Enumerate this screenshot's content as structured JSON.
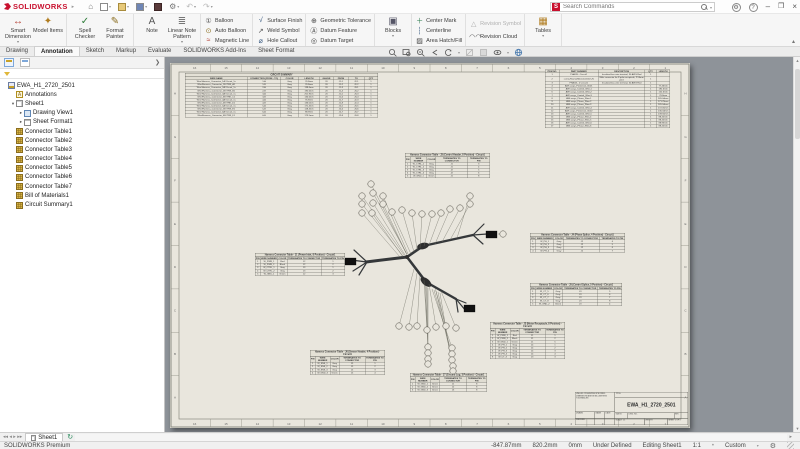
{
  "window": {
    "logo": "SOLIDWORKS",
    "search_placeholder": "Search Commands"
  },
  "ribbon": {
    "tabs": [
      "Drawing",
      "Annotation",
      "Sketch",
      "Markup",
      "Evaluate",
      "SOLIDWORKS Add-Ins",
      "Sheet Format"
    ],
    "active_tab": "Annotation",
    "groups": [
      {
        "type": "big",
        "buttons": [
          {
            "label": "Smart Dimension",
            "icon": "smart-dimension",
            "caret": true
          },
          {
            "label": "Model Items",
            "icon": "model-items"
          }
        ]
      },
      {
        "type": "big",
        "buttons": [
          {
            "label": "Spell Checker",
            "icon": "spell-checker"
          },
          {
            "label": "Format Painter",
            "icon": "format-painter"
          }
        ]
      },
      {
        "type": "big",
        "buttons": [
          {
            "label": "Note",
            "icon": "note"
          },
          {
            "label": "Linear Note Pattern",
            "icon": "linear-note-pattern",
            "caret": true
          }
        ]
      },
      {
        "type": "stack",
        "buttons": [
          {
            "label": "Balloon",
            "icon": "balloon"
          },
          {
            "label": "Auto Balloon",
            "icon": "auto-balloon"
          },
          {
            "label": "Magnetic Line",
            "icon": "magnetic-line"
          }
        ]
      },
      {
        "type": "stack",
        "buttons": [
          {
            "label": "Surface Finish",
            "icon": "surface-finish"
          },
          {
            "label": "Weld Symbol",
            "icon": "weld-symbol"
          },
          {
            "label": "Hole Callout",
            "icon": "hole-callout"
          }
        ]
      },
      {
        "type": "stack",
        "buttons": [
          {
            "label": "Geometric Tolerance",
            "icon": "geometric-tolerance"
          },
          {
            "label": "Datum Feature",
            "icon": "datum-feature"
          },
          {
            "label": "Datum Target",
            "icon": "datum-target"
          }
        ]
      },
      {
        "type": "big",
        "buttons": [
          {
            "label": "Blocks",
            "icon": "blocks",
            "caret": true
          }
        ]
      },
      {
        "type": "stack",
        "buttons": [
          {
            "label": "Center Mark",
            "icon": "center-mark"
          },
          {
            "label": "Centerline",
            "icon": "centerline"
          },
          {
            "label": "Area Hatch/Fill",
            "icon": "area-hatch"
          }
        ]
      },
      {
        "type": "stack",
        "buttons": [
          {
            "label": "Revision Symbol",
            "icon": "revision-symbol",
            "disabled": true
          },
          {
            "label": "Revision Cloud",
            "icon": "revision-cloud"
          }
        ]
      },
      {
        "type": "big",
        "buttons": [
          {
            "label": "Tables",
            "icon": "tables",
            "caret": true
          }
        ]
      }
    ]
  },
  "tree": {
    "items": [
      {
        "label": "EWA_H1_2720_2501",
        "icon": "ti-doc",
        "depth": 0,
        "arrow": ""
      },
      {
        "label": "Annotations",
        "icon": "ti-note",
        "depth": 1,
        "arrow": "",
        "glyph": "A"
      },
      {
        "label": "Sheet1",
        "icon": "ti-sheet",
        "depth": 1,
        "arrow": "expanded"
      },
      {
        "label": "Drawing View1",
        "icon": "ti-view",
        "depth": 2,
        "arrow": "collapsed"
      },
      {
        "label": "Sheet Format1",
        "icon": "ti-format",
        "depth": 2,
        "arrow": "collapsed"
      },
      {
        "label": "Connector Table1",
        "icon": "ti-table",
        "depth": 1,
        "arrow": ""
      },
      {
        "label": "Connector Table2",
        "icon": "ti-table",
        "depth": 1,
        "arrow": ""
      },
      {
        "label": "Connector Table3",
        "icon": "ti-table",
        "depth": 1,
        "arrow": ""
      },
      {
        "label": "Connector Table4",
        "icon": "ti-table",
        "depth": 1,
        "arrow": ""
      },
      {
        "label": "Connector Table5",
        "icon": "ti-table",
        "depth": 1,
        "arrow": ""
      },
      {
        "label": "Connector Table6",
        "icon": "ti-table",
        "depth": 1,
        "arrow": ""
      },
      {
        "label": "Connector Table7",
        "icon": "ti-table",
        "depth": 1,
        "arrow": ""
      },
      {
        "label": "Bill of Materials1",
        "icon": "ti-table",
        "depth": 1,
        "arrow": ""
      },
      {
        "label": "Circuit Summary1",
        "icon": "ti-table",
        "depth": 1,
        "arrow": ""
      }
    ]
  },
  "sheet": {
    "zones_h": [
      "16",
      "15",
      "14",
      "13",
      "12",
      "11",
      "10",
      "9",
      "8",
      "7",
      "6",
      "5",
      "4",
      "3",
      "2",
      "1"
    ],
    "zones_v": [
      "H",
      "G",
      "F",
      "E",
      "D",
      "C",
      "B",
      "A"
    ],
    "circuit_summary": {
      "title": "CIRCUIT SUMMARY",
      "headers": [
        "WIRE NAME",
        "CONNECTION (FROM - TO)",
        "COLOR",
        "LENGTH",
        "GAUGE",
        "FROM",
        "TO",
        "QTY"
      ],
      "rows": [
        [
          "Wire/Harness_Connector_1A /Circuit_1s",
          "1-A",
          "Gray",
          "76.8mm",
          "20",
          "J1-1",
          "J2-1",
          "1"
        ],
        [
          "Wire/Harness_Connector_1B /TRK_A1",
          "1-B",
          "Gray",
          "76.8mm",
          "20",
          "J1-2",
          "J2-2",
          "1"
        ],
        [
          "Wire/Harness_Connector_2A /Circuit_1s",
          "2-A",
          "Gray",
          "138.6mm",
          "20",
          "J1-3",
          "J3-1",
          "1"
        ],
        [
          "Wire/Harness_Connector_2B /TRK_B1",
          "2-B",
          "Gray",
          "192.6mm",
          "20",
          "J1-4",
          "J3-2",
          "1"
        ],
        [
          "Wire/Harness_Connector_3A /Circuit_1s",
          "3-A",
          "Gray",
          "201.9mm",
          "20",
          "J1-5",
          "J3-3",
          "1"
        ],
        [
          "Wire/Harness_Connector_3B /TRK_C1",
          "3-B",
          "Gray",
          "134.6mm",
          "20",
          "J1-6",
          "J3-4",
          "1"
        ],
        [
          "Wire/Harness_Connector_4A /Circuit_1s",
          "4-A",
          "Gray",
          "76.8mm",
          "20",
          "J1-7",
          "J2-3",
          "1"
        ],
        [
          "Wire/Harness_Connector_4B /TRK_D1",
          "4-B",
          "Gray",
          "136.0mm",
          "20",
          "J1-8",
          "J2-4",
          "1"
        ],
        [
          "Wire/Harness_Connector_5A /Circuit_1s",
          "5-A",
          "Gray",
          "171.4mm",
          "20",
          "J2-5",
          "J3-5",
          "1"
        ],
        [
          "Wire/Harness_Connector_5B /TRK_E1",
          "5-B",
          "Gray",
          "128.4mm",
          "20",
          "J2-6",
          "J3-6",
          "1"
        ],
        [
          "Wire/Harness_Connector_6A /Circuit_1s",
          "6-A",
          "Gray",
          "88.9mm",
          "20",
          "J2-7",
          "J3-7",
          "1"
        ],
        [
          "Wire/Harness_Connector_6B /TRK_F1",
          "6-B",
          "Gray",
          "173.5mm",
          "20",
          "J2-8",
          "J3-8",
          "1"
        ]
      ]
    },
    "bom": {
      "headers": [
        "ITEM NO.",
        "PART NUMBER",
        "DESCRIPTION",
        "QTY.",
        "LENGTH"
      ],
      "rows": [
        [
          "1",
          "PHACB - Circuit1",
          "Insulated bus wire terminal, 30 AWG Red",
          "1",
          ""
        ],
        [
          "2",
          "screw-Round-M2x0.4x16mm-N",
          "Male connector for 8 pole receptacle, 2.54mm pitch",
          "1",
          ""
        ],
        [
          "3",
          "PHACB - 2 Circuit1",
          "Insulated bus wire terminal, 30 AWG Red",
          "1",
          ""
        ],
        [
          "4",
          "AWI assys_Protection_W-01",
          "",
          "1",
          "77.46mm"
        ],
        [
          "5",
          "AWI assys_Control_Wire-1",
          "",
          "1",
          "192.6mm"
        ],
        [
          "6",
          "AWI assys_Control_Wire-2",
          "",
          "1",
          "152.6mm"
        ],
        [
          "7",
          "AWI assys_Control_Wire-3",
          "",
          "1",
          "76.8mm"
        ],
        [
          "8",
          "AWI assys_Phase_Wire-1",
          "",
          "1",
          "165.04mm"
        ],
        [
          "9",
          "AWI assys_Phase_Wire-2",
          "",
          "1",
          "171.76mm"
        ],
        [
          "10",
          "AWI assys_Phase_Wire-3",
          "",
          "1",
          "165.04mm"
        ],
        [
          "11",
          "AWI assys_Control_Wire-4",
          "",
          "1",
          "172.05mm"
        ],
        [
          "12",
          "AWI assys_Protection_W-02",
          "",
          "1",
          "136.34mm"
        ],
        [
          "13",
          "AWI assys_Control_Wire-5",
          "",
          "1",
          "139.56mm"
        ],
        [
          "14",
          "AWI assys_Phase_Wire-4",
          "",
          "1",
          "88.45mm"
        ],
        [
          "15",
          "AWI assys_Phase_Wire-5",
          "",
          "1",
          "88.45mm"
        ],
        [
          "16",
          "AWI assys_Control_Wire-6",
          "",
          "1",
          "88.93mm"
        ],
        [
          "17",
          "AWI assys_Phase_Wire-6",
          "",
          "1",
          "88.45mm"
        ]
      ]
    },
    "connector_headers": [
      "PIN",
      "WIRE NUMBER",
      "COLOR",
      "TERMINATES TO CONNECTOR",
      "TERMINATES TO PIN"
    ],
    "connector_tables": [
      {
        "title": "Harness Connector Table - J3 (Control Header, 8 Position) - Circuit1",
        "rows": [
          [
            "1",
            "W_CTRL_1",
            "Gray",
            "J1",
            "3"
          ],
          [
            "2",
            "W_CTRL_2",
            "Gray",
            "J1",
            "4"
          ],
          [
            "3",
            "W_CTRL_3",
            "Gray",
            "J2",
            "5"
          ],
          [
            "4",
            "W_CTRL_4",
            "Gray",
            "J2",
            "6"
          ],
          [
            "5",
            "W_GND_1",
            "Green",
            "J1",
            "8"
          ]
        ]
      },
      {
        "title": "Harness Connector Table - J1 (Power Inlet, 8 Position) - Circuit1",
        "rows": [
          [
            "1",
            "W_PWR_1",
            "Red",
            "J2",
            "1"
          ],
          [
            "2",
            "W_PWR_2",
            "Black",
            "J2",
            "2"
          ],
          [
            "3",
            "W_CTRL_1",
            "Gray",
            "J3",
            "1"
          ],
          [
            "4",
            "W_CTRL_2",
            "Gray",
            "J3",
            "2"
          ],
          [
            "5",
            "W_GND_1",
            "Green",
            "J2",
            "3"
          ]
        ]
      },
      {
        "title": "Harness Connector Table - J4 (Phase Splice, 4 Position) - Circuit1",
        "rows": [
          [
            "1",
            "W_PH_1",
            "Gray",
            "J2",
            "4"
          ],
          [
            "2",
            "W_PH_2",
            "Gray",
            "J2",
            "5"
          ],
          [
            "3",
            "W_PH_3",
            "Gray",
            "J2",
            "6"
          ],
          [
            "4",
            "W_PH_4",
            "Gray",
            "J2",
            "7"
          ]
        ]
      },
      {
        "title": "Harness Connector Table - J5 (Control Splice, 5 Position) - Circuit1",
        "rows": [
          [
            "1",
            "W_CT_5",
            "Gray",
            "J3",
            "5"
          ],
          [
            "2",
            "W_CT_6",
            "Gray",
            "J3",
            "6"
          ],
          [
            "3",
            "W_CT_7",
            "Gray",
            "J3",
            "7"
          ],
          [
            "4",
            "W_CT_8",
            "Gray",
            "J3",
            "8"
          ],
          [
            "5",
            "W_GND_2",
            "Green",
            "J3",
            "4"
          ]
        ]
      },
      {
        "title": "Harness Connector Table - J2 (Motor Receptacle, 8 Position) - Circuit1",
        "rows": [
          [
            "1",
            "W_PWR_1",
            "Red",
            "J1",
            "1"
          ],
          [
            "2",
            "W_PWR_2",
            "Black",
            "J1",
            "2"
          ],
          [
            "3",
            "W_GND_1",
            "Green",
            "J1",
            "5"
          ],
          [
            "4",
            "W_PH_1",
            "Gray",
            "J4",
            "1"
          ],
          [
            "5",
            "W_PH_2",
            "Gray",
            "J4",
            "2"
          ],
          [
            "6",
            "W_PH_3",
            "Gray",
            "J4",
            "3"
          ],
          [
            "7",
            "W_PH_4",
            "Gray",
            "J4",
            "4"
          ],
          [
            "8",
            "W_CT_3",
            "Gray",
            "J3",
            "3"
          ]
        ]
      },
      {
        "title": "Harness Connector Table - J6 (Sensor Header, 4 Position) - Circuit1",
        "rows": [
          [
            "1",
            "W_SNS_1",
            "Gray",
            "J5",
            "1"
          ],
          [
            "2",
            "W_SNS_2",
            "Gray",
            "J5",
            "2"
          ],
          [
            "3",
            "W_SNS_3",
            "Gray",
            "J5",
            "3"
          ],
          [
            "4",
            "W_GND_3",
            "Green",
            "J5",
            "4"
          ]
        ]
      },
      {
        "title": "Harness Connector Table - J7 (Ground Lug, 3 Position) - Circuit1",
        "rows": [
          [
            "1",
            "W_GND_1",
            "Green",
            "J1",
            "8"
          ],
          [
            "2",
            "W_GND_2",
            "Green",
            "J2",
            "8"
          ],
          [
            "3",
            "W_GND_3",
            "Green",
            "J3",
            "8"
          ]
        ]
      }
    ],
    "title_block": {
      "note1": "UNLESS OTHERWISE SPECIFIED:",
      "note2": "DIMENSIONS ARE IN MILLIMETERS",
      "note3": "TOLERANCES:",
      "name_label": "NAME",
      "date_label": "DATE",
      "drawn_label": "DRAWN",
      "checked_label": "CHECKED",
      "title_label": "TITLE:",
      "size_label": "SIZE",
      "size": "B",
      "dwgno_label": "DWG. NO.",
      "rev_label": "REV",
      "dwg_no": "EWA_H1_2720_2501",
      "scale": "SCALE: 1:1",
      "weight": "WEIGHT:",
      "sheet": "SHEET 1 OF 1"
    }
  },
  "sheet_tabs": {
    "active": "Sheet1"
  },
  "status": {
    "app": "SOLIDWORKS Premium",
    "x": "-847.87mm",
    "y": "820.2mm",
    "z": "0mm",
    "state": "Under Defined",
    "mode": "Editing Sheet1",
    "scale": "1:1",
    "units": "Custom"
  }
}
